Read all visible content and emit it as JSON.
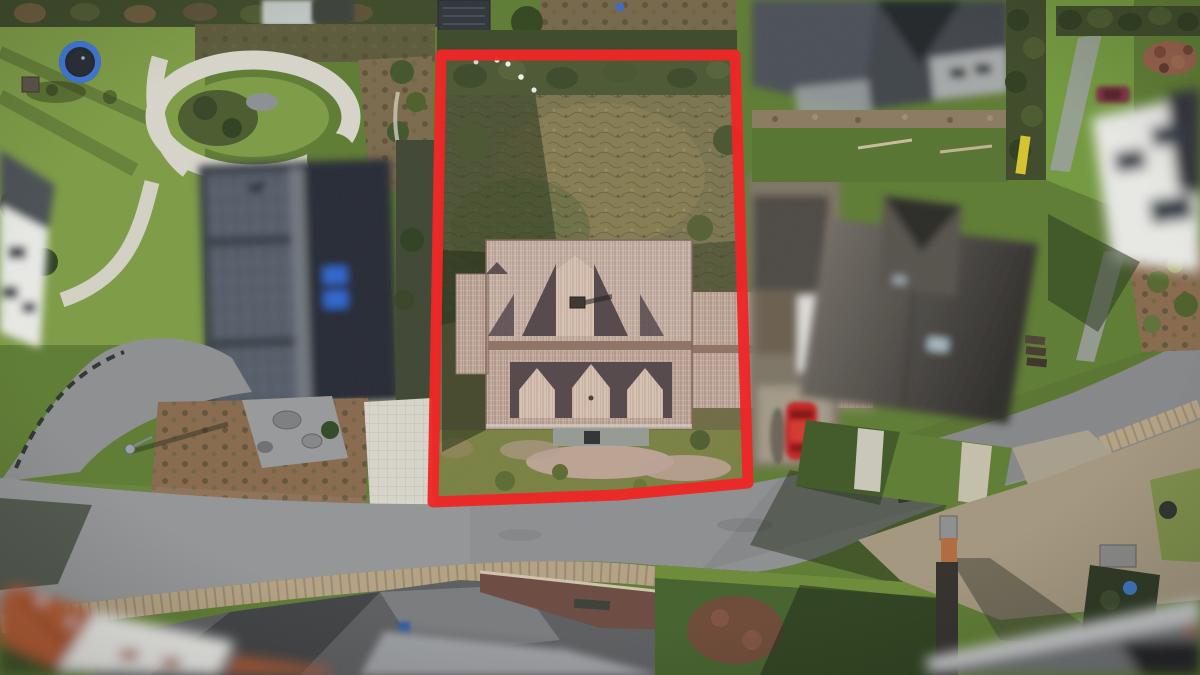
{
  "meta": {
    "type": "aerial-drone-photograph",
    "description": "Top-down aerial drone photo of a suburban street. A bright red polygon outlines a property lot containing an in-focus house with a beige clay-tile roof, gabled dormers and an overgrown rear garden. All neighbouring houses, cars and buildings are blurred for privacy. A curved asphalt road with cobblestone edging crosses the lower part of the frame; gardens, lawns, a trampoline, rock beds and driveways surround it.",
    "width_px": 1200,
    "height_px": 675
  },
  "boundary": {
    "label": "marked-property-lot",
    "points": "441,55 735,55 748,483 618,495 433,502",
    "stroke_width": 11,
    "color": "#ee2626"
  },
  "objects": {
    "main_house": "in-focus house with beige tiled roof, three south dormers, one north cross-gable, chimney, east wing",
    "rear_garden": "overgrown brown scrub inside the red boundary",
    "left_house": "blurred dark roof with solar panels and two blue skylights",
    "right_house": "blurred grey hipped roof with cross gable and skylight",
    "red_car": "red car parked beside the boundary",
    "maroon_car": "small dark-red car top right",
    "trampoline": "blue-rimmed trampoline on top-left lawn",
    "orange_roofs": "blurred orange tiled roofs bottom-left",
    "road": "grey asphalt road with cobble sidewalks",
    "island": "dark red-brown paved island with bench below the road",
    "gravel_yard": "bare gravel yard bottom right with brick pillars"
  },
  "palette": {
    "grassSun": "#7d9c45",
    "grassMid": "#5e7c33",
    "grassDark": "#3c5528",
    "hedge": "#3d4a29",
    "scrub": "#7b7550",
    "scrubDark": "#4d5a33",
    "mulch": "#886a4d",
    "gravel": "#97999b",
    "pathWhite": "#d8d5cb",
    "road": "#8d8f91",
    "roadDark": "#6d6f71",
    "cobble": "#b4a284",
    "dirt": "#a4977f",
    "roofTan": "#c3ab9d",
    "roofTanLight": "#d8c3b4",
    "roofRidge": "#8f7365",
    "dormerShadow": "#54474b",
    "roofGrayL": "#383e46",
    "solar": "#59616d",
    "skylightBlue": "#2e66cf",
    "roofGrayR1": "#7a746c",
    "roofGrayR2": "#2f2d2b",
    "whiteWall": "#e9e9e6",
    "orangeRoof": "#b25a33",
    "redCar": "#c62222",
    "maroonCar": "#7e3040",
    "trampMat": "#222832",
    "trampRim": "#3f76d9",
    "brick": "#b26a3e",
    "islandPave": "#6b4a41",
    "shrubRed": "#744539",
    "shadow": "#1c2613",
    "boundary": "#ee2626"
  }
}
